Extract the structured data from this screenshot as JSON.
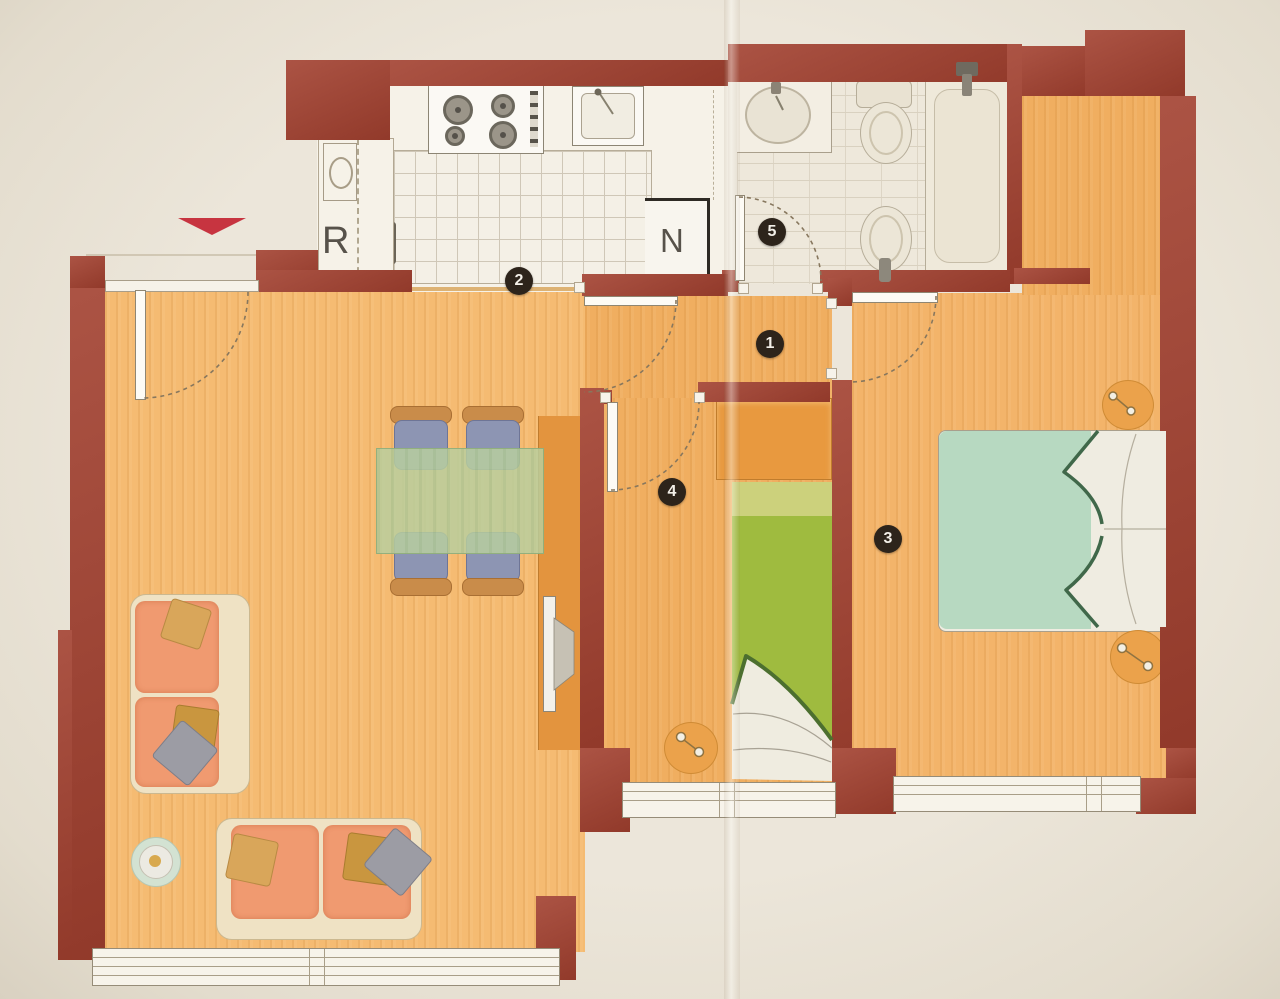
{
  "markers": [
    {
      "label": "1"
    },
    {
      "label": "2"
    },
    {
      "label": "3"
    },
    {
      "label": "4"
    },
    {
      "label": "5"
    }
  ],
  "letters": {
    "r": "R",
    "n": "N"
  },
  "colors": {
    "wall": "#a2402f",
    "wood_floor": "#f2b368",
    "kitchen_floor": "#f6f2e8",
    "bathroom_floor": "#eee8db",
    "double_bed": "#b7d9c1",
    "single_bed": "#9fbb3f",
    "sofa": "#f09a70",
    "dining_table": "#b8ce9e",
    "chair_seat": "#8d95b3",
    "cabinet": "#e6953f",
    "marker_background": "#2d241b",
    "entrance_arrow": "#c73440",
    "paper": "#e9e3d7"
  }
}
